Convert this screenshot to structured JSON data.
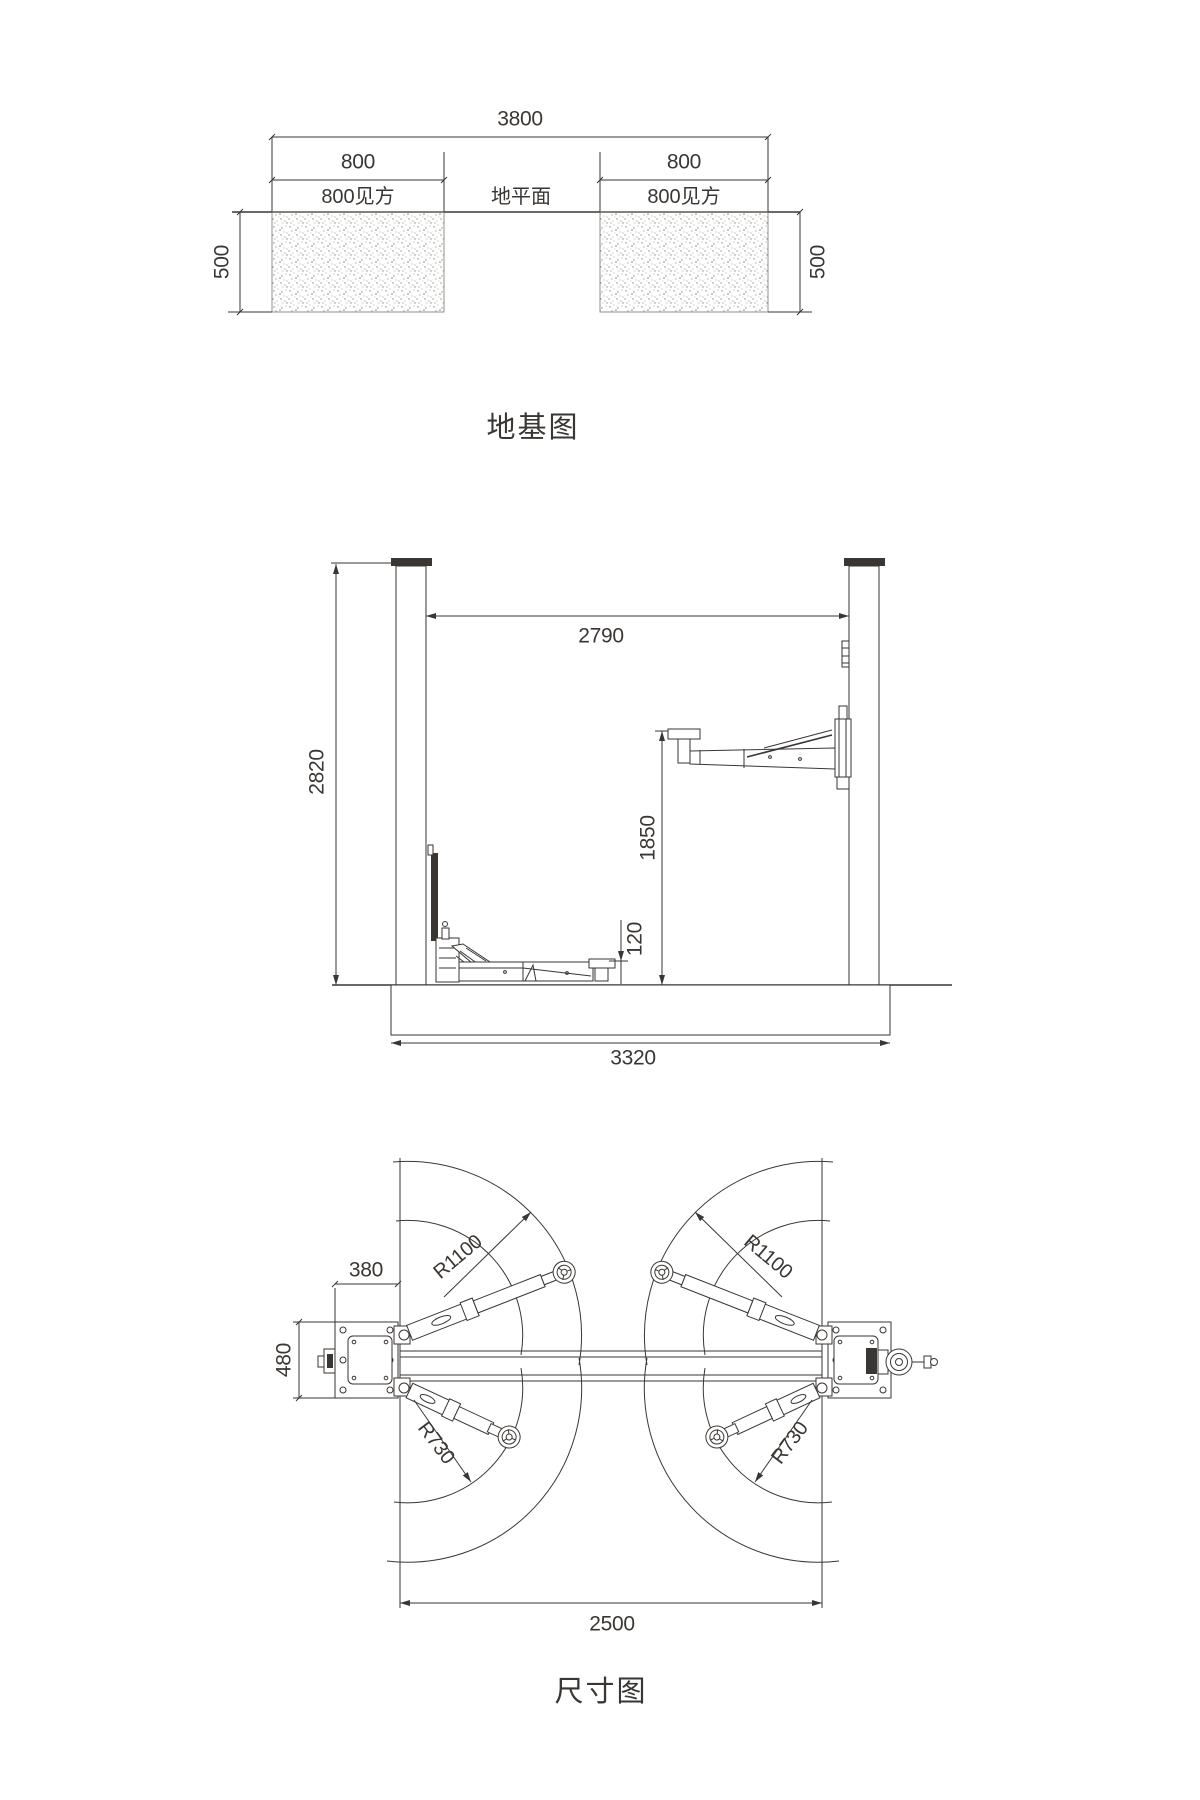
{
  "drawing": {
    "type": "two-post-lift-technical-drawing",
    "colors": {
      "line": "#3a3633",
      "background": "#ffffff",
      "stipple": "#8d877e"
    }
  },
  "foundation_view": {
    "title": "地基图",
    "dim_overall_width": "3800",
    "dim_left_pad_width": "800",
    "dim_right_pad_width": "800",
    "label_left_pad": "800见方",
    "label_ground_plane": "地平面",
    "label_right_pad": "800见方",
    "dim_depth_left": "500",
    "dim_depth_right": "500"
  },
  "elevation_view": {
    "dim_clear_width": "2790",
    "dim_column_height": "2820",
    "dim_lift_height": "1850",
    "dim_min_pad_height": "120",
    "dim_base_width": "3320"
  },
  "plan_view": {
    "title": "尺寸图",
    "dim_plate_width": "380",
    "dim_plate_depth": "480",
    "dim_drive_through": "2500",
    "label_long_arm_radius_left": "R1100",
    "label_long_arm_radius_right": "R1100",
    "label_short_arm_radius_left": "R730",
    "label_short_arm_radius_right": "R730"
  }
}
